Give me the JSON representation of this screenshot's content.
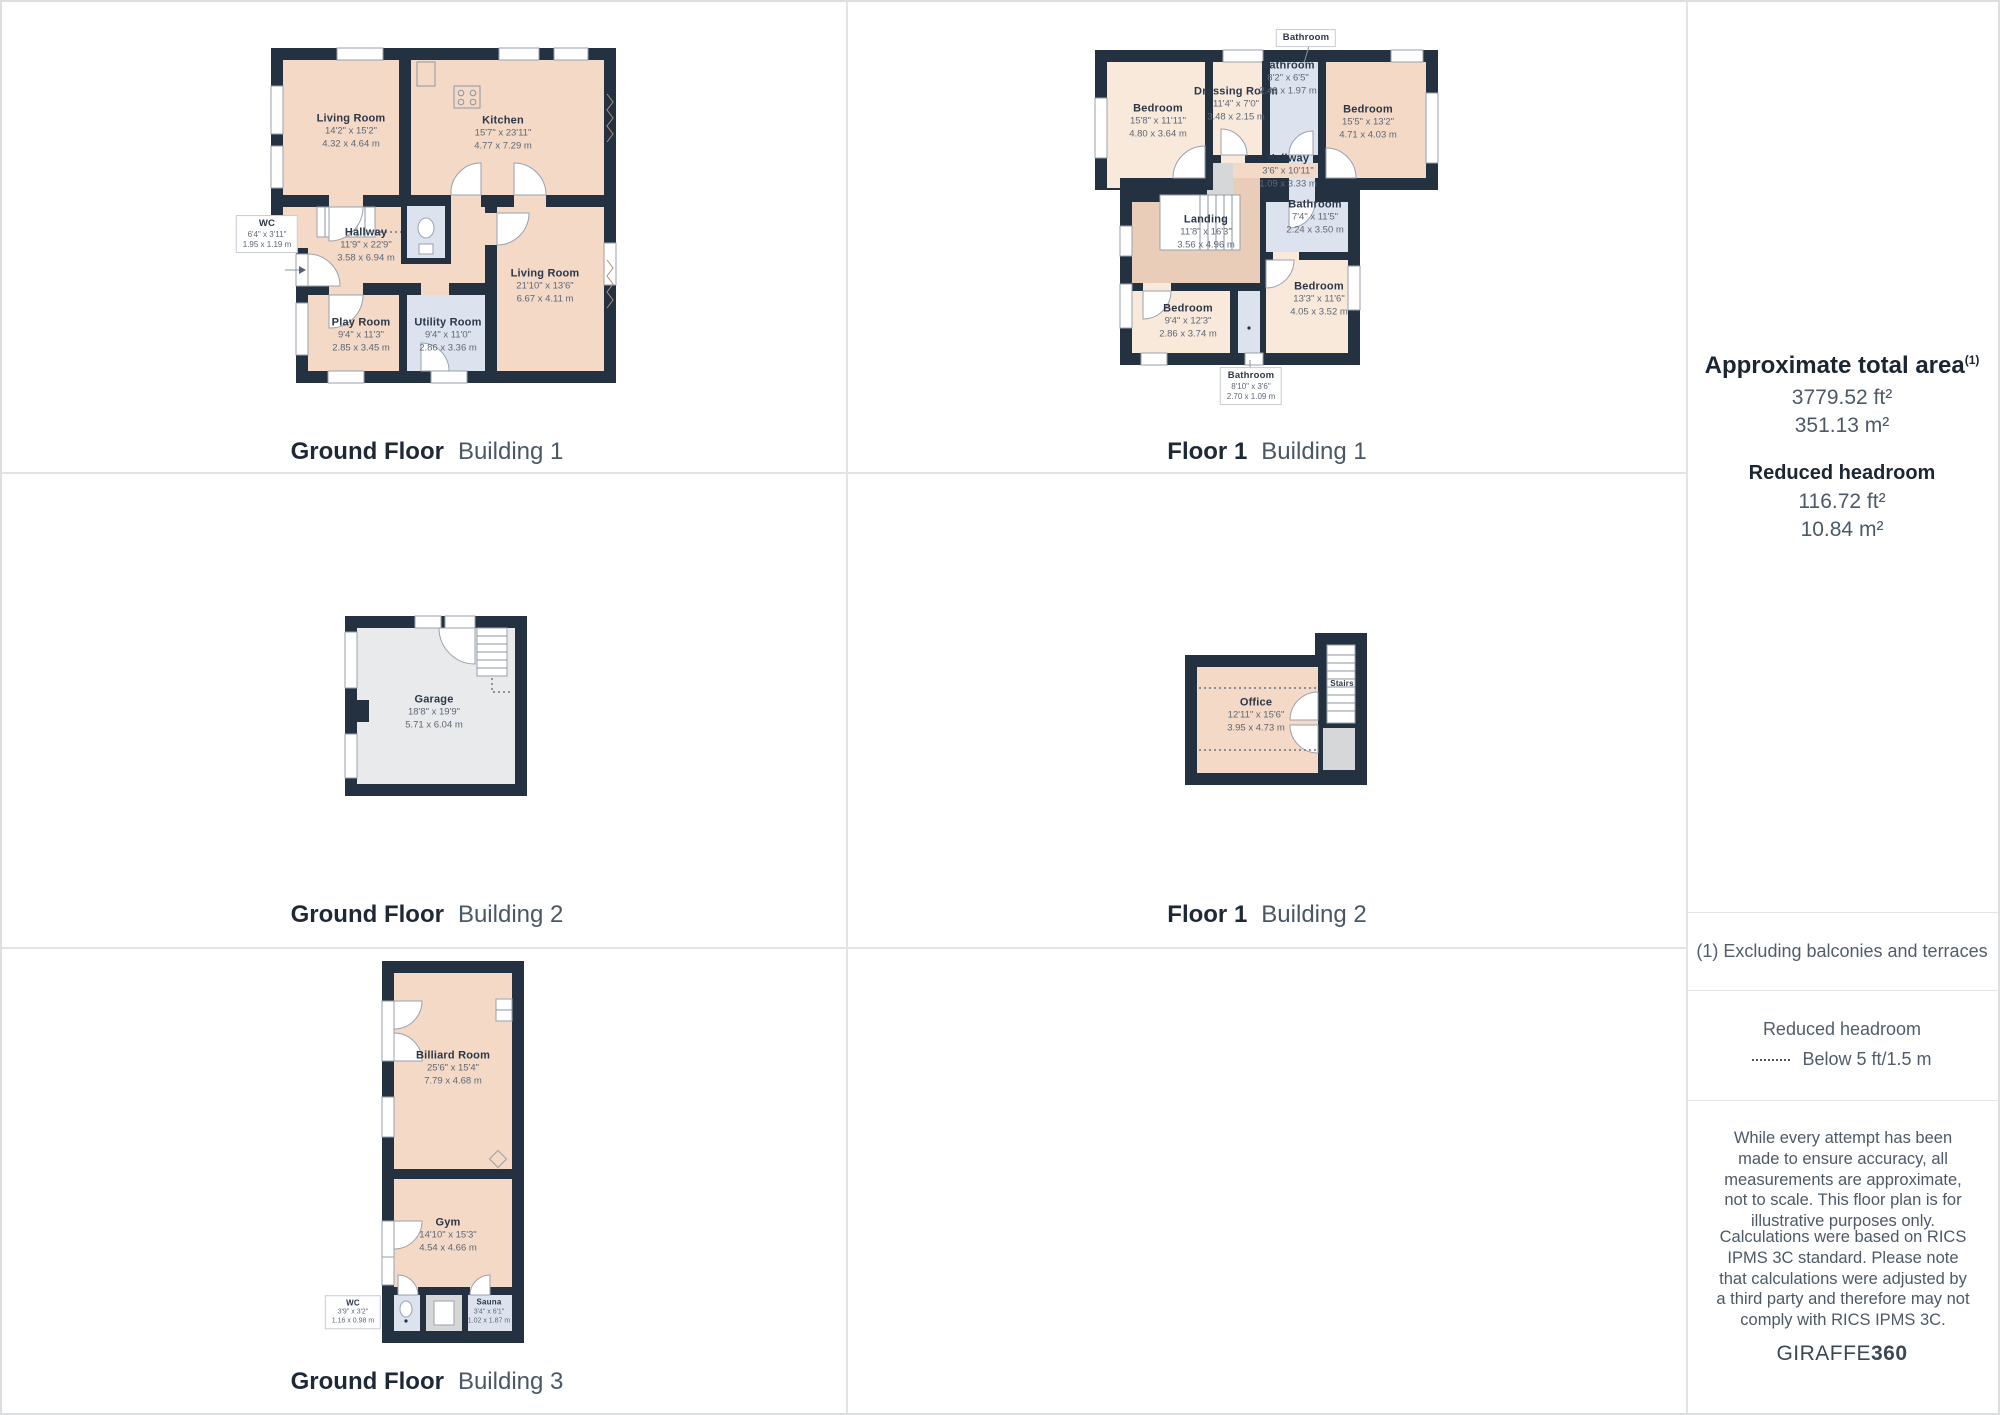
{
  "captions": {
    "gf_b1": {
      "floor": "Ground Floor",
      "building": "Building 1"
    },
    "f1_b1": {
      "floor": "Floor 1",
      "building": "Building 1"
    },
    "gf_b2": {
      "floor": "Ground Floor",
      "building": "Building 2"
    },
    "f1_b2": {
      "floor": "Floor 1",
      "building": "Building 2"
    },
    "gf_b3": {
      "floor": "Ground Floor",
      "building": "Building 3"
    }
  },
  "rooms": {
    "gf_b1": {
      "living1": {
        "name": "Living Room",
        "ft": "14'2\" x 15'2\"",
        "m": "4.32 x 4.64 m"
      },
      "kitchen": {
        "name": "Kitchen",
        "ft": "15'7\" x 23'11\"",
        "m": "4.77 x 7.29 m"
      },
      "wc": {
        "name": "WC",
        "ft": "6'4\" x 3'11\"",
        "m": "1.95 x 1.19 m"
      },
      "hallway": {
        "name": "Hallway",
        "ft": "11'9\" x 22'9\"",
        "m": "3.58 x 6.94 m"
      },
      "living2": {
        "name": "Living Room",
        "ft": "21'10\" x 13'6\"",
        "m": "6.67 x 4.11 m"
      },
      "play": {
        "name": "Play Room",
        "ft": "9'4\" x 11'3\"",
        "m": "2.85 x 3.45 m"
      },
      "utility": {
        "name": "Utility Room",
        "ft": "9'4\" x 11'0\"",
        "m": "2.86 x 3.36 m"
      }
    },
    "f1_b1": {
      "bath_callout_top": {
        "name": "Bathroom"
      },
      "bedroom_tl": {
        "name": "Bedroom",
        "ft": "15'8\" x 11'11\"",
        "m": "4.80 x 3.64 m"
      },
      "dressing": {
        "name": "Dressing Room",
        "ft": "11'4\" x 7'0\"",
        "m": "3.48 x 2.15 m"
      },
      "bath_top": {
        "name": "Bathroom",
        "ft": "8'2\" x 6'5\"",
        "m": "2.49 x 1.97 m"
      },
      "bedroom_tr": {
        "name": "Bedroom",
        "ft": "15'5\" x 13'2\"",
        "m": "4.71 x 4.03 m"
      },
      "hallway": {
        "name": "Hallway",
        "ft": "3'6\" x 10'11\"",
        "m": "1.09 x 3.33 m"
      },
      "landing": {
        "name": "Landing",
        "ft": "11'8\" x 16'3\"",
        "m": "3.56 x 4.96 m"
      },
      "bath_mid": {
        "name": "Bathroom",
        "ft": "7'4\" x 11'5\"",
        "m": "2.24 x 3.50 m"
      },
      "bedroom_bl": {
        "name": "Bedroom",
        "ft": "9'4\" x 12'3\"",
        "m": "2.86 x 3.74 m"
      },
      "bedroom_br": {
        "name": "Bedroom",
        "ft": "13'3\" x 11'6\"",
        "m": "4.05 x 3.52 m"
      },
      "bath_callout_bottom": {
        "name": "Bathroom",
        "ft": "8'10\" x 3'6\"",
        "m": "2.70 x 1.09 m"
      }
    },
    "gf_b2": {
      "garage": {
        "name": "Garage",
        "ft": "18'8\" x 19'9\"",
        "m": "5.71 x 6.04 m"
      }
    },
    "f1_b2": {
      "office": {
        "name": "Office",
        "ft": "12'11\" x 15'6\"",
        "m": "3.95 x 4.73 m"
      },
      "stairs": {
        "name": "Stairs"
      }
    },
    "gf_b3": {
      "billiard": {
        "name": "Billiard Room",
        "ft": "25'6\" x 15'4\"",
        "m": "7.79 x 4.68 m"
      },
      "gym": {
        "name": "Gym",
        "ft": "14'10\" x 15'3\"",
        "m": "4.54 x 4.66 m"
      },
      "wc": {
        "name": "WC",
        "ft": "3'9\" x 3'2\"",
        "m": "1.16 x 0.98 m"
      },
      "sauna": {
        "name": "Sauna",
        "ft": "3'4\" x 6'1\"",
        "m": "1.02 x 1.87 m"
      }
    }
  },
  "panel": {
    "total_area_title": "Approximate total area",
    "total_area_superscript": "(1)",
    "total_area_ft": "3779.52 ft²",
    "total_area_m": "351.13 m²",
    "reduced_title": "Reduced headroom",
    "reduced_ft": "116.72 ft²",
    "reduced_m": "10.84 m²",
    "footnote": "(1) Excluding balconies and terraces",
    "legend_title": "Reduced headroom",
    "legend_label": "Below 5 ft/1.5 m",
    "disclaimer1": "While every attempt has been made to ensure accuracy, all measurements are approximate, not to scale. This floor plan is for illustrative purposes only.",
    "disclaimer2": "Calculations were based on RICS IPMS 3C standard. Please note that calculations were adjusted by a third party and therefore may not comply with RICS IPMS 3C.",
    "brand_regular": "GIRAFFE",
    "brand_bold": "360"
  },
  "colors": {
    "wall": "#233140",
    "room_peach": "#f3d9c6",
    "room_peach_light": "#f9e9db",
    "room_peach_dark": "#e9cdb8",
    "room_blue": "#dde3ee",
    "room_gray": "#e9eaec",
    "room_gray_dark": "#d6d7d9",
    "divider": "#e3e4e6",
    "text_dark": "#1c2633",
    "text_gray": "#4d5966"
  }
}
